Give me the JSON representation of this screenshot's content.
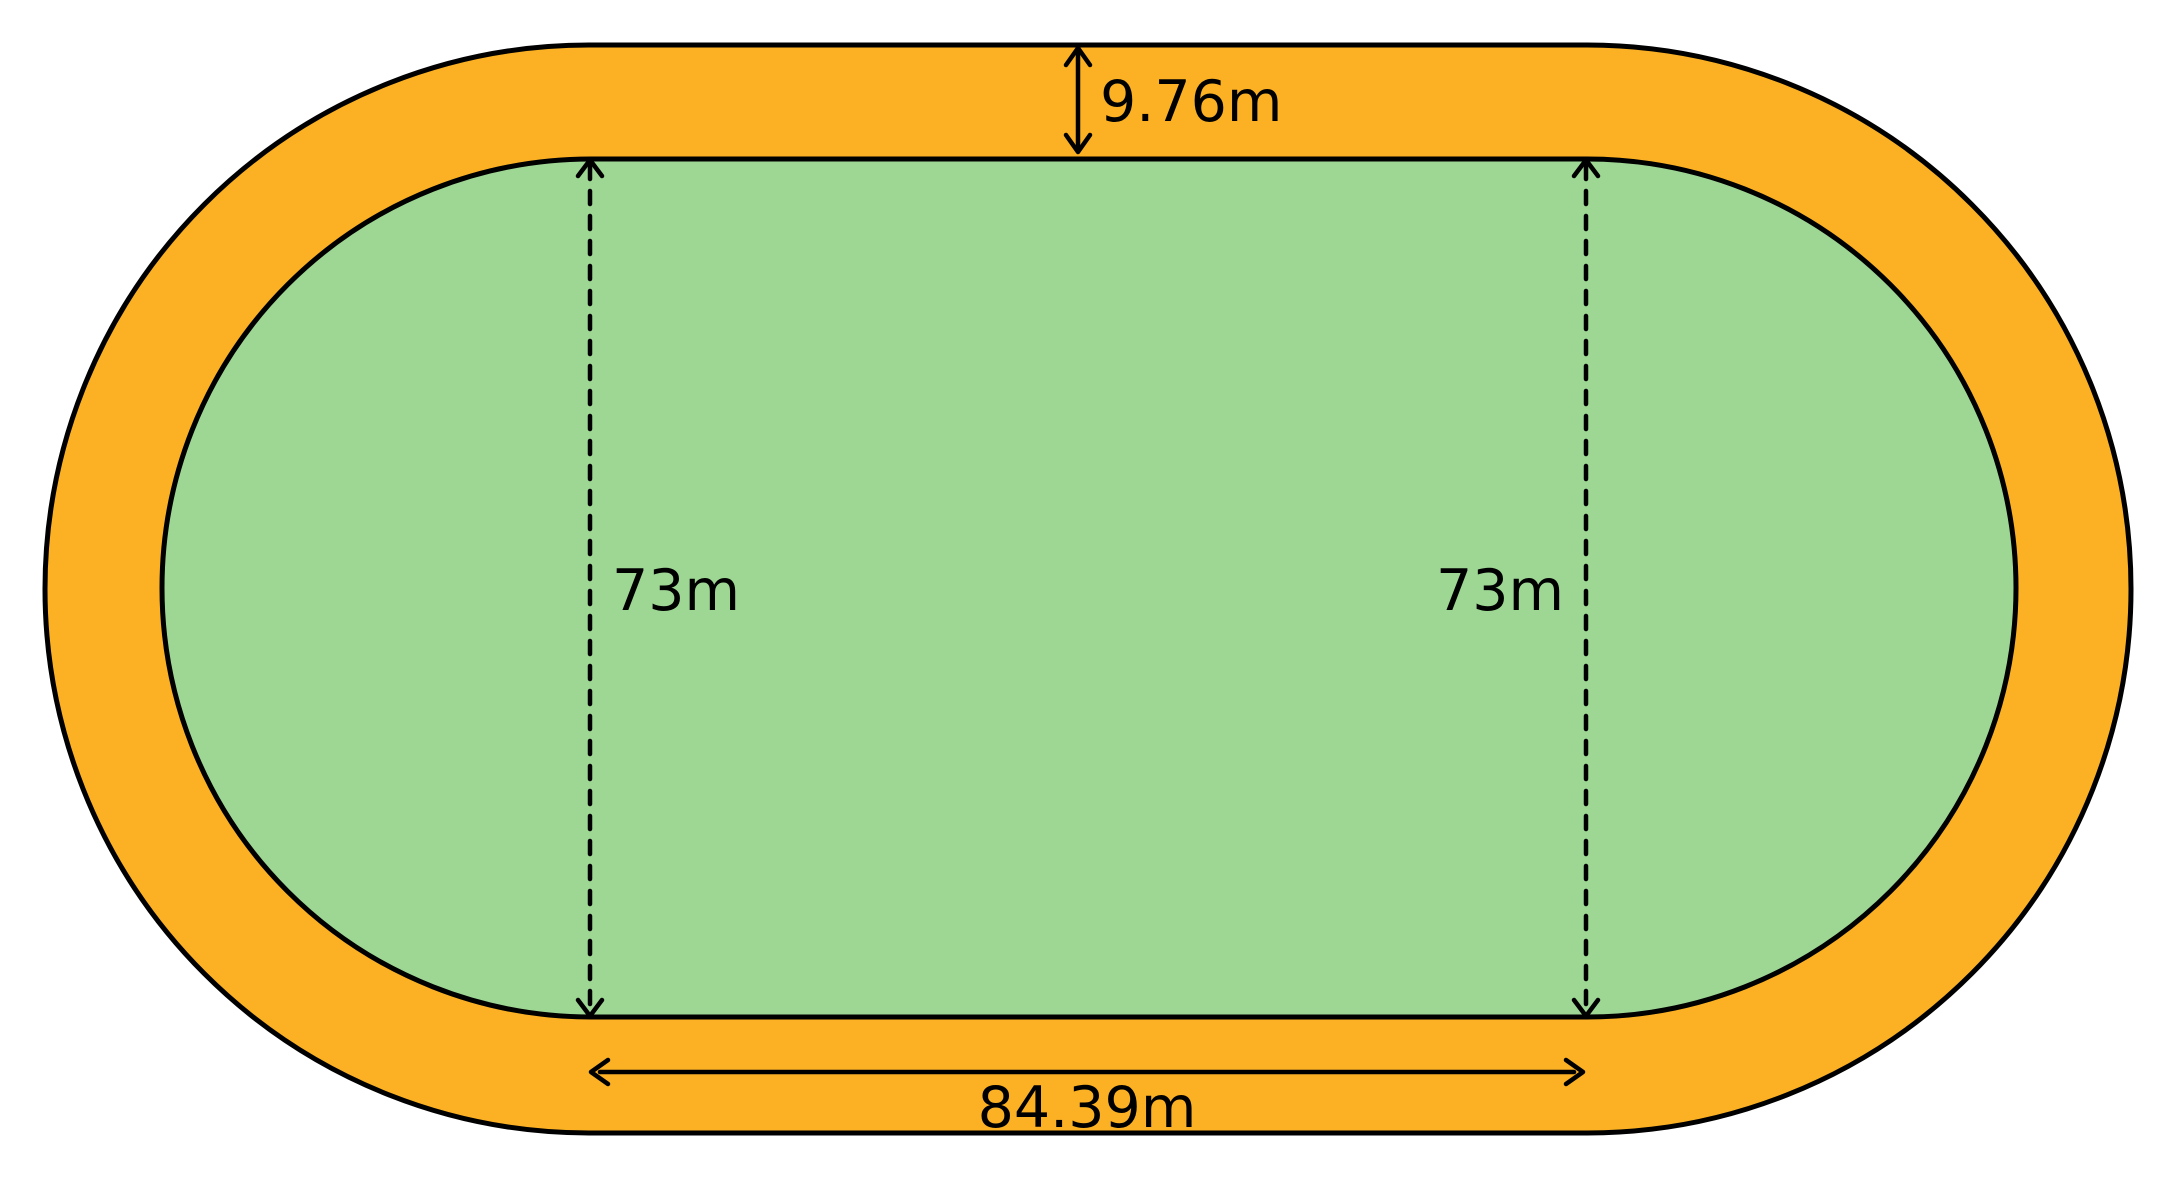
{
  "diagram": {
    "type": "stadium-running-track",
    "background": "#FFFFFF",
    "colors": {
      "track_fill": "#FBB123",
      "field_fill": "#9ED694",
      "outline": "#000000",
      "text": "#000000"
    },
    "labels": {
      "track_width": "9.76m",
      "field_width_left": "73m",
      "field_width_right": "73m",
      "straight_length": "84.39m"
    },
    "measurements": {
      "track_lane_width_m": 9.76,
      "infield_width_m": 73,
      "straight_length_m": 84.39
    }
  }
}
